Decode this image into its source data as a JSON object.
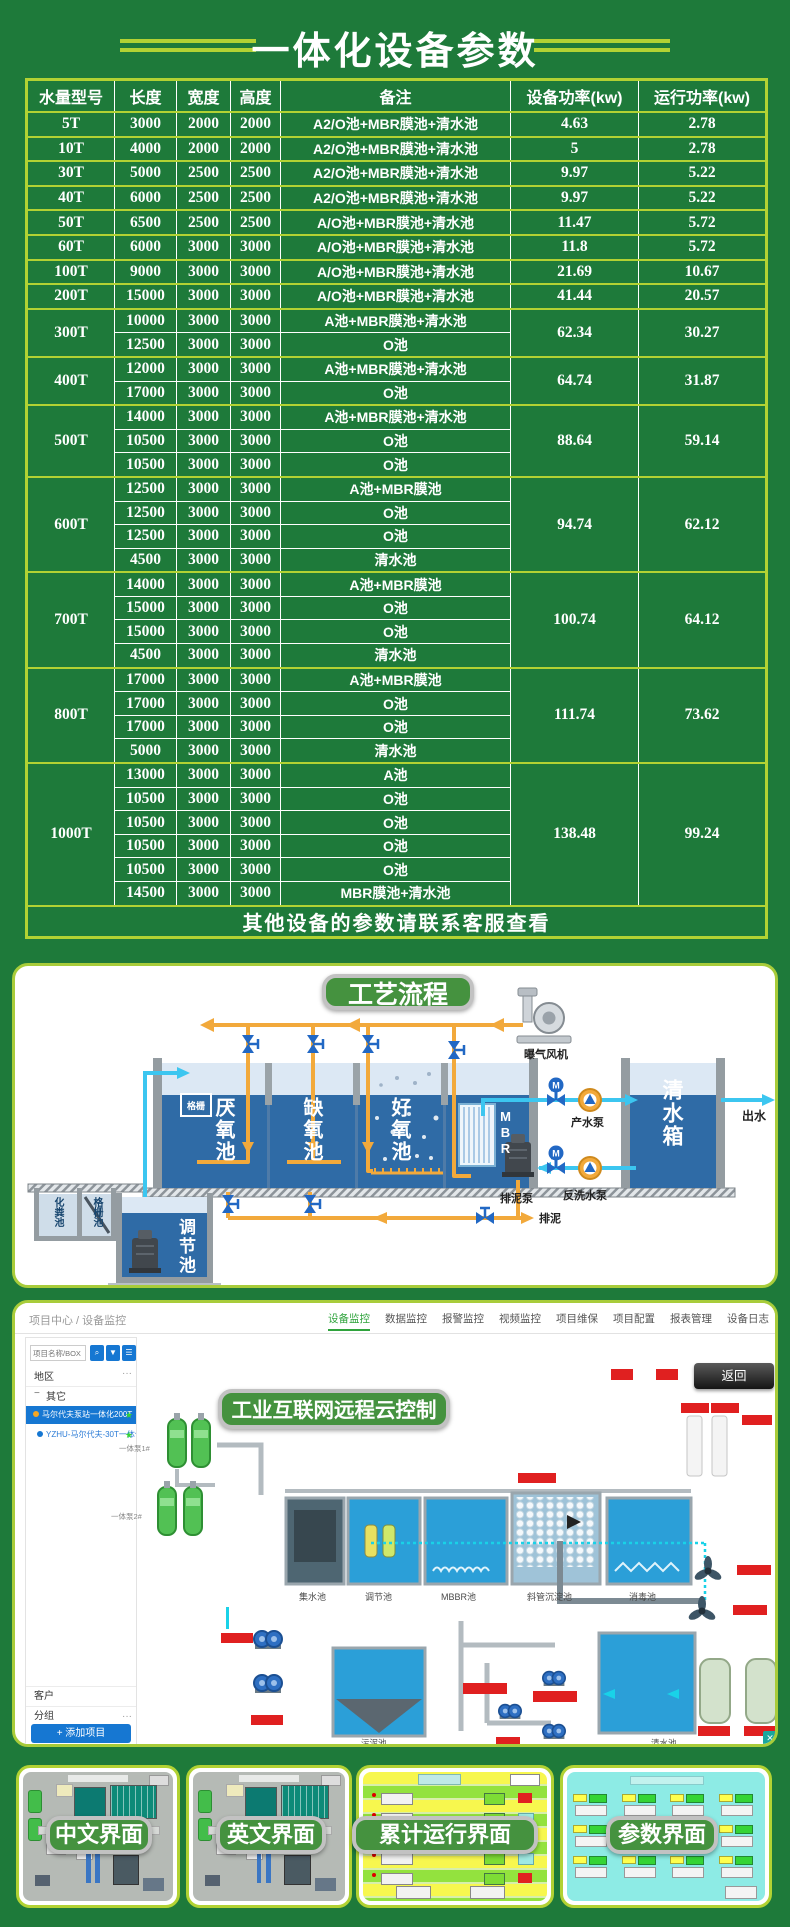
{
  "page": {
    "background": "#1e7a3a",
    "accent": "#b2d233"
  },
  "header": {
    "title": "一体化设备参数"
  },
  "table": {
    "headers": [
      "水量型号",
      "长度",
      "宽度",
      "高度",
      "备注",
      "设备功率(kw)",
      "运行功率(kw)"
    ],
    "groups": [
      {
        "model": "5T",
        "rows": [
          [
            "3000",
            "2000",
            "2000",
            "A2/O池+MBR膜池+清水池"
          ]
        ],
        "device_power": "4.63",
        "run_power": "2.78"
      },
      {
        "model": "10T",
        "rows": [
          [
            "4000",
            "2000",
            "2000",
            "A2/O池+MBR膜池+清水池"
          ]
        ],
        "device_power": "5",
        "run_power": "2.78"
      },
      {
        "model": "30T",
        "rows": [
          [
            "5000",
            "2500",
            "2500",
            "A2/O池+MBR膜池+清水池"
          ]
        ],
        "device_power": "9.97",
        "run_power": "5.22"
      },
      {
        "model": "40T",
        "rows": [
          [
            "6000",
            "2500",
            "2500",
            "A2/O池+MBR膜池+清水池"
          ]
        ],
        "device_power": "9.97",
        "run_power": "5.22"
      },
      {
        "model": "50T",
        "rows": [
          [
            "6500",
            "2500",
            "2500",
            "A/O池+MBR膜池+清水池"
          ]
        ],
        "device_power": "11.47",
        "run_power": "5.72"
      },
      {
        "model": "60T",
        "rows": [
          [
            "6000",
            "3000",
            "3000",
            "A/O池+MBR膜池+清水池"
          ]
        ],
        "device_power": "11.8",
        "run_power": "5.72"
      },
      {
        "model": "100T",
        "rows": [
          [
            "9000",
            "3000",
            "3000",
            "A/O池+MBR膜池+清水池"
          ]
        ],
        "device_power": "21.69",
        "run_power": "10.67"
      },
      {
        "model": "200T",
        "rows": [
          [
            "15000",
            "3000",
            "3000",
            "A/O池+MBR膜池+清水池"
          ]
        ],
        "device_power": "41.44",
        "run_power": "20.57"
      },
      {
        "model": "300T",
        "rows": [
          [
            "10000",
            "3000",
            "3000",
            "A池+MBR膜池+清水池"
          ],
          [
            "12500",
            "3000",
            "3000",
            "O池"
          ]
        ],
        "device_power": "62.34",
        "run_power": "30.27"
      },
      {
        "model": "400T",
        "rows": [
          [
            "12000",
            "3000",
            "3000",
            "A池+MBR膜池+清水池"
          ],
          [
            "17000",
            "3000",
            "3000",
            "O池"
          ]
        ],
        "device_power": "64.74",
        "run_power": "31.87"
      },
      {
        "model": "500T",
        "rows": [
          [
            "14000",
            "3000",
            "3000",
            "A池+MBR膜池+清水池"
          ],
          [
            "10500",
            "3000",
            "3000",
            "O池"
          ],
          [
            "10500",
            "3000",
            "3000",
            "O池"
          ]
        ],
        "device_power": "88.64",
        "run_power": "59.14"
      },
      {
        "model": "600T",
        "rows": [
          [
            "12500",
            "3000",
            "3000",
            "A池+MBR膜池"
          ],
          [
            "12500",
            "3000",
            "3000",
            "O池"
          ],
          [
            "12500",
            "3000",
            "3000",
            "O池"
          ],
          [
            "4500",
            "3000",
            "3000",
            "清水池"
          ]
        ],
        "device_power": "94.74",
        "run_power": "62.12"
      },
      {
        "model": "700T",
        "rows": [
          [
            "14000",
            "3000",
            "3000",
            "A池+MBR膜池"
          ],
          [
            "15000",
            "3000",
            "3000",
            "O池"
          ],
          [
            "15000",
            "3000",
            "3000",
            "O池"
          ],
          [
            "4500",
            "3000",
            "3000",
            "清水池"
          ]
        ],
        "device_power": "100.74",
        "run_power": "64.12"
      },
      {
        "model": "800T",
        "rows": [
          [
            "17000",
            "3000",
            "3000",
            "A池+MBR膜池"
          ],
          [
            "17000",
            "3000",
            "3000",
            "O池"
          ],
          [
            "17000",
            "3000",
            "3000",
            "O池"
          ],
          [
            "5000",
            "3000",
            "3000",
            "清水池"
          ]
        ],
        "device_power": "111.74",
        "run_power": "73.62"
      },
      {
        "model": "1000T",
        "rows": [
          [
            "13000",
            "3000",
            "3000",
            "A池"
          ],
          [
            "10500",
            "3000",
            "3000",
            "O池"
          ],
          [
            "10500",
            "3000",
            "3000",
            "O池"
          ],
          [
            "10500",
            "3000",
            "3000",
            "O池"
          ],
          [
            "10500",
            "3000",
            "3000",
            "O池"
          ],
          [
            "14500",
            "3000",
            "3000",
            "MBR膜池+清水池"
          ]
        ],
        "device_power": "138.48",
        "run_power": "99.24"
      }
    ],
    "footer": "其他设备的参数请联系客服查看"
  },
  "process": {
    "badge": "工艺流程",
    "labels": {
      "blower": "曝气风机",
      "anaerobic": "厌氧池",
      "anoxic": "缺氧池",
      "aerobic": "好氧池",
      "mbr": "MBR",
      "grid": "格栅",
      "product_pump": "产水泵",
      "clean_tank": "清水箱",
      "outflow": "出水",
      "septic_tank": "化粪池",
      "grid_tank": "格栅池",
      "regulating_tank": "调节池",
      "sludge_pump": "排泥泵",
      "backwash_pump": "反洗水泵",
      "sludge_out": "排泥"
    }
  },
  "iot": {
    "breadcrumb": "项目中心 / 设备监控",
    "tabs": [
      "设备监控",
      "数据监控",
      "报警监控",
      "视频监控",
      "项目维保",
      "项目配置",
      "报表管理",
      "设备日志"
    ],
    "badge": "工业互联网远程云控制",
    "back_button": "返回",
    "sidebar": {
      "search_placeholder": "项目名称/BOX ID",
      "region_label": "地区",
      "more": "···",
      "root_node": "其它",
      "item_selected": "马尔代夫泵站一体化200T",
      "item_second": "YZHU-马尔代夫-30T一体化设",
      "customer_label": "客户",
      "group_label": "分组",
      "add_button": "+ 添加项目"
    },
    "canvas": {
      "pump_label_1": "一体泵1#",
      "pump_label_2": "一体泵2#",
      "tanks": [
        "集水池",
        "调节池",
        "MBBR池",
        "斜管沉淀池",
        "消毒池"
      ],
      "sludge_tank": "污泥池",
      "clean_tank": "清水池"
    }
  },
  "screens": {
    "panels": [
      {
        "label": "中文界面"
      },
      {
        "label": "英文界面"
      },
      {
        "label": "累计运行界面"
      },
      {
        "label": "参数界面"
      }
    ]
  }
}
